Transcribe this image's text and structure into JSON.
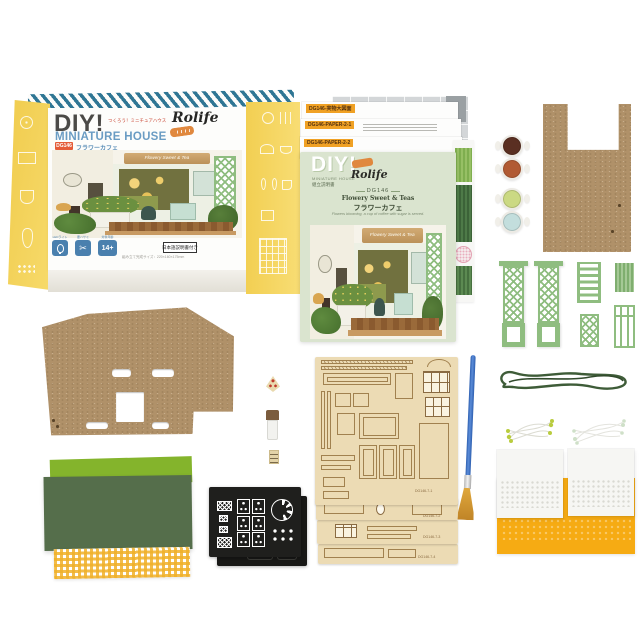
{
  "product": {
    "brand": "Rolife",
    "model": "DG146",
    "name_en": "Flowery Sweet & Teas",
    "name_jp": "フラワーカフェ"
  },
  "box": {
    "title": "DIY!",
    "title_note": "つくろう！ミニチュアハウス",
    "series": "MINIATURE HOUSE",
    "model_badge": "DG146",
    "name_jp": "フラワーカフェ",
    "brand": "Rolife",
    "cafe_sign": "Flowery Sweet & Tea",
    "badge_led_label": "LEDライト",
    "badge_tools_label": "要ハサミ",
    "badge_age_label": "対象年齢",
    "badge_age_value": "14+",
    "manual_note": "日本語説明書付き",
    "size_note": "組み立て完成サイズ：220×160×175mm"
  },
  "icons": {
    "scissors": "✂"
  },
  "papers": {
    "labels": [
      "DG146-実物大図面",
      "DG146-PAPER-2-1",
      "DG146-PAPER-2-2"
    ]
  },
  "booklet": {
    "title": "DIY!",
    "series": "MINIATURE HOUSE",
    "subtitle": "組立説明書",
    "brand": "Rolife",
    "model": "DG146",
    "name_en": "Flowery Sweet & Teas",
    "name_jp": "フラワーカフェ",
    "tagline": "Flowers blooming, a cup of coffee with sugar is served.",
    "cafe_sign": "Flowery Sweet & Tea"
  },
  "wood_sheets": {
    "labels": [
      "DG146-7-1",
      "DG146-7-2",
      "DG146-7-3",
      "DG146-7-4"
    ]
  },
  "paints": {
    "colors": [
      "#5a2f22",
      "#b15a33",
      "#cbd983",
      "#c3dedd"
    ]
  },
  "palette": {
    "box_yellow": "#f5d65f",
    "stripe_blue": "#2f7694",
    "badge_blue": "#4a80ae",
    "model_orange": "#e55c38",
    "booklet_green": "#dae4cf",
    "trellis_green": "#8fbd80",
    "mdf_brown": "#b09169",
    "wood_sheet_tan": "#ecdbb4",
    "felt_bright_green": "#84b42c",
    "felt_dark_green": "#556e4b",
    "gingham_yellow": "#f0b029",
    "black_sheet": "#1f1f1d",
    "brush_handle_blue": "#3a6fc0",
    "brush_bristle_gold": "#d39a33",
    "wire_green": "#3e5c38",
    "pattern_paper_yellow": "#f6ab13"
  }
}
